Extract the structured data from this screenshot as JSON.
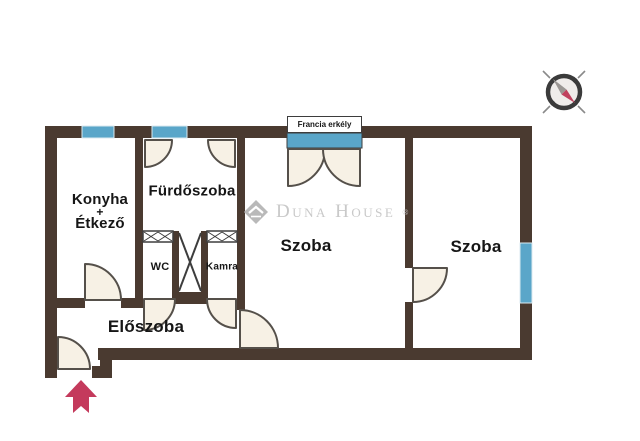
{
  "title": "Apartment floor plan",
  "rooms": {
    "kitchen_dining": {
      "line1": "Konyha",
      "line2": "+",
      "line3": "Étkező"
    },
    "bathroom": {
      "label": "Fürdőszoba"
    },
    "wc": {
      "label": "WC"
    },
    "pantry": {
      "label": "Kamra"
    },
    "room_left": {
      "label": "Szoba"
    },
    "room_right": {
      "label": "Szoba"
    },
    "hallway": {
      "label": "Előszoba"
    },
    "french_balcony": {
      "label": "Francia erkély"
    }
  },
  "watermark": {
    "brand": "Duna House",
    "registered_mark": "®"
  },
  "icons": {
    "compass": "compass-rose-icon",
    "entrance_arrow": "entrance-arrow-icon",
    "brand_logo": "duna-house-diamond-icon"
  },
  "colors": {
    "wall": "#4a3a30",
    "window_blue": "#5aa6c9",
    "door_fill": "#f7f1e5",
    "door_stroke": "#55504a",
    "label_text": "#161616",
    "watermark_gray": "#c9c9c9",
    "arrow_red": "#c43a5c",
    "compass_dark": "#3b3b3b",
    "compass_needle_red": "#c0415e",
    "compass_needle_gray": "#9a9693"
  }
}
